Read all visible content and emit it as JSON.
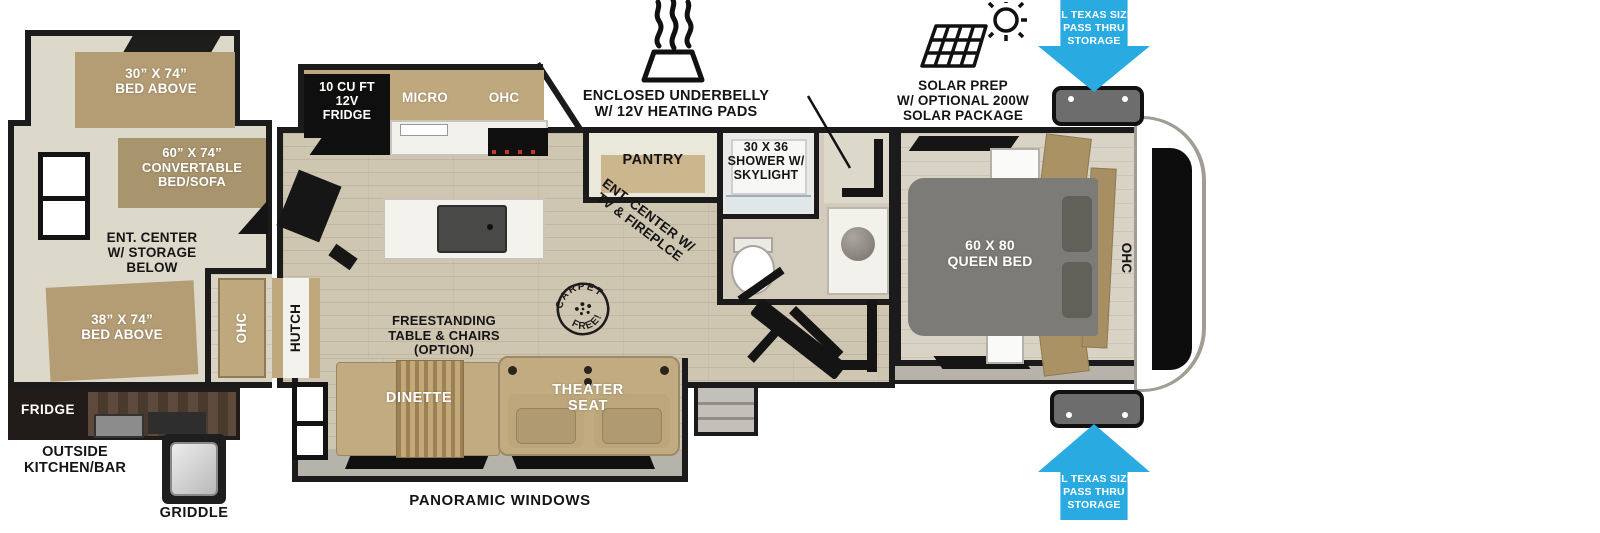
{
  "colors": {
    "accent_blue": "#29ABE2",
    "wall_black": "#1b1b1b",
    "bed_tan": "#b49c74",
    "bed_gray": "#7c7b77"
  },
  "callouts": {
    "underbelly": "ENCLOSED UNDERBELLY\nW/ 12V HEATING PADS",
    "washer_dryer": "WASHER/\nDRYER\nPREP",
    "solar": "SOLAR PREP\nW/ OPTIONAL 200W\nSOLAR PACKAGE",
    "pass_thru": "XL TEXAS SIZE\nPASS THRU\nSTORAGE",
    "panoramic_windows": "PANORAMIC WINDOWS"
  },
  "rear_room": {
    "bunk_top": "30” X 74”\nBED ABOVE",
    "convertible": "60” X 74”\nCONVERTABLE\nBED/SOFA",
    "ent_center": "ENT. CENTER\nW/ STORAGE\nBELOW",
    "bunk_bottom": "38” X 74”\nBED ABOVE",
    "ohc": "OHC",
    "hutch": "HUTCH"
  },
  "outside_kitchen": {
    "fridge": "FRIDGE",
    "title": "OUTSIDE\nKITCHEN/BAR",
    "griddle": "GRIDDLE"
  },
  "kitchen": {
    "fridge_12v": "10 CU FT\n12V\nFRIDGE",
    "micro": "MICRO",
    "ohc": "OHC",
    "pantry": "PANTRY"
  },
  "living": {
    "ent_center": "ENT. CENTER W/\nTV & FIREPLCE",
    "freestanding": "FREESTANDING\nTABLE & CHAIRS\n(OPTION)",
    "dinette": "DINETTE",
    "theater_seat": "THEATER\nSEAT",
    "carpet_free_top": "CARPET",
    "carpet_free_bottom": "FREE!"
  },
  "bath": {
    "shower": "30 X 36\nSHOWER W/\nSKYLIGHT"
  },
  "bedroom": {
    "queen_bed": "60 X 80\nQUEEN BED",
    "ohc": "OHC"
  }
}
